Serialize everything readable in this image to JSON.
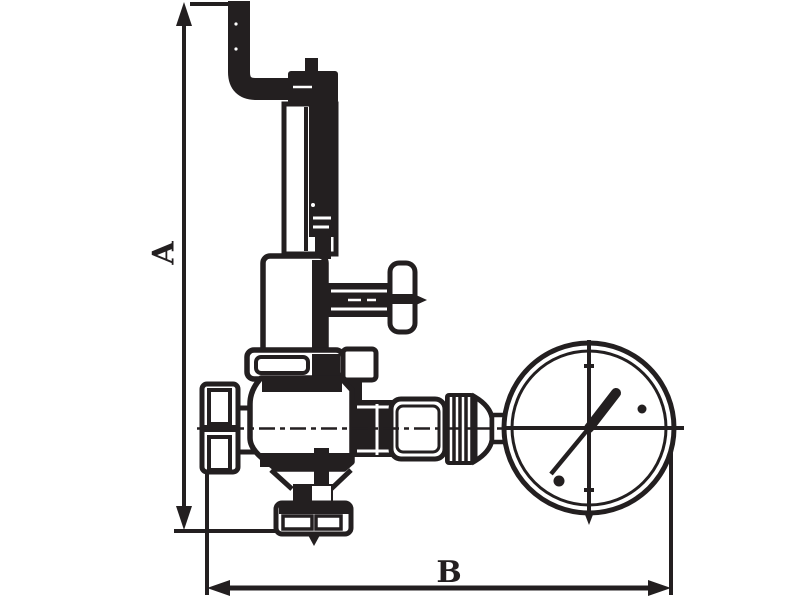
{
  "diagram": {
    "type": "technical-line-drawing",
    "subject": "pressure reducing valve with Z-bend vent pipe, side tap handle and pressure gauge",
    "ink_color": "#231f20",
    "background_color": "#ffffff",
    "dimension_labels": {
      "vertical": "A",
      "horizontal": "B"
    }
  }
}
